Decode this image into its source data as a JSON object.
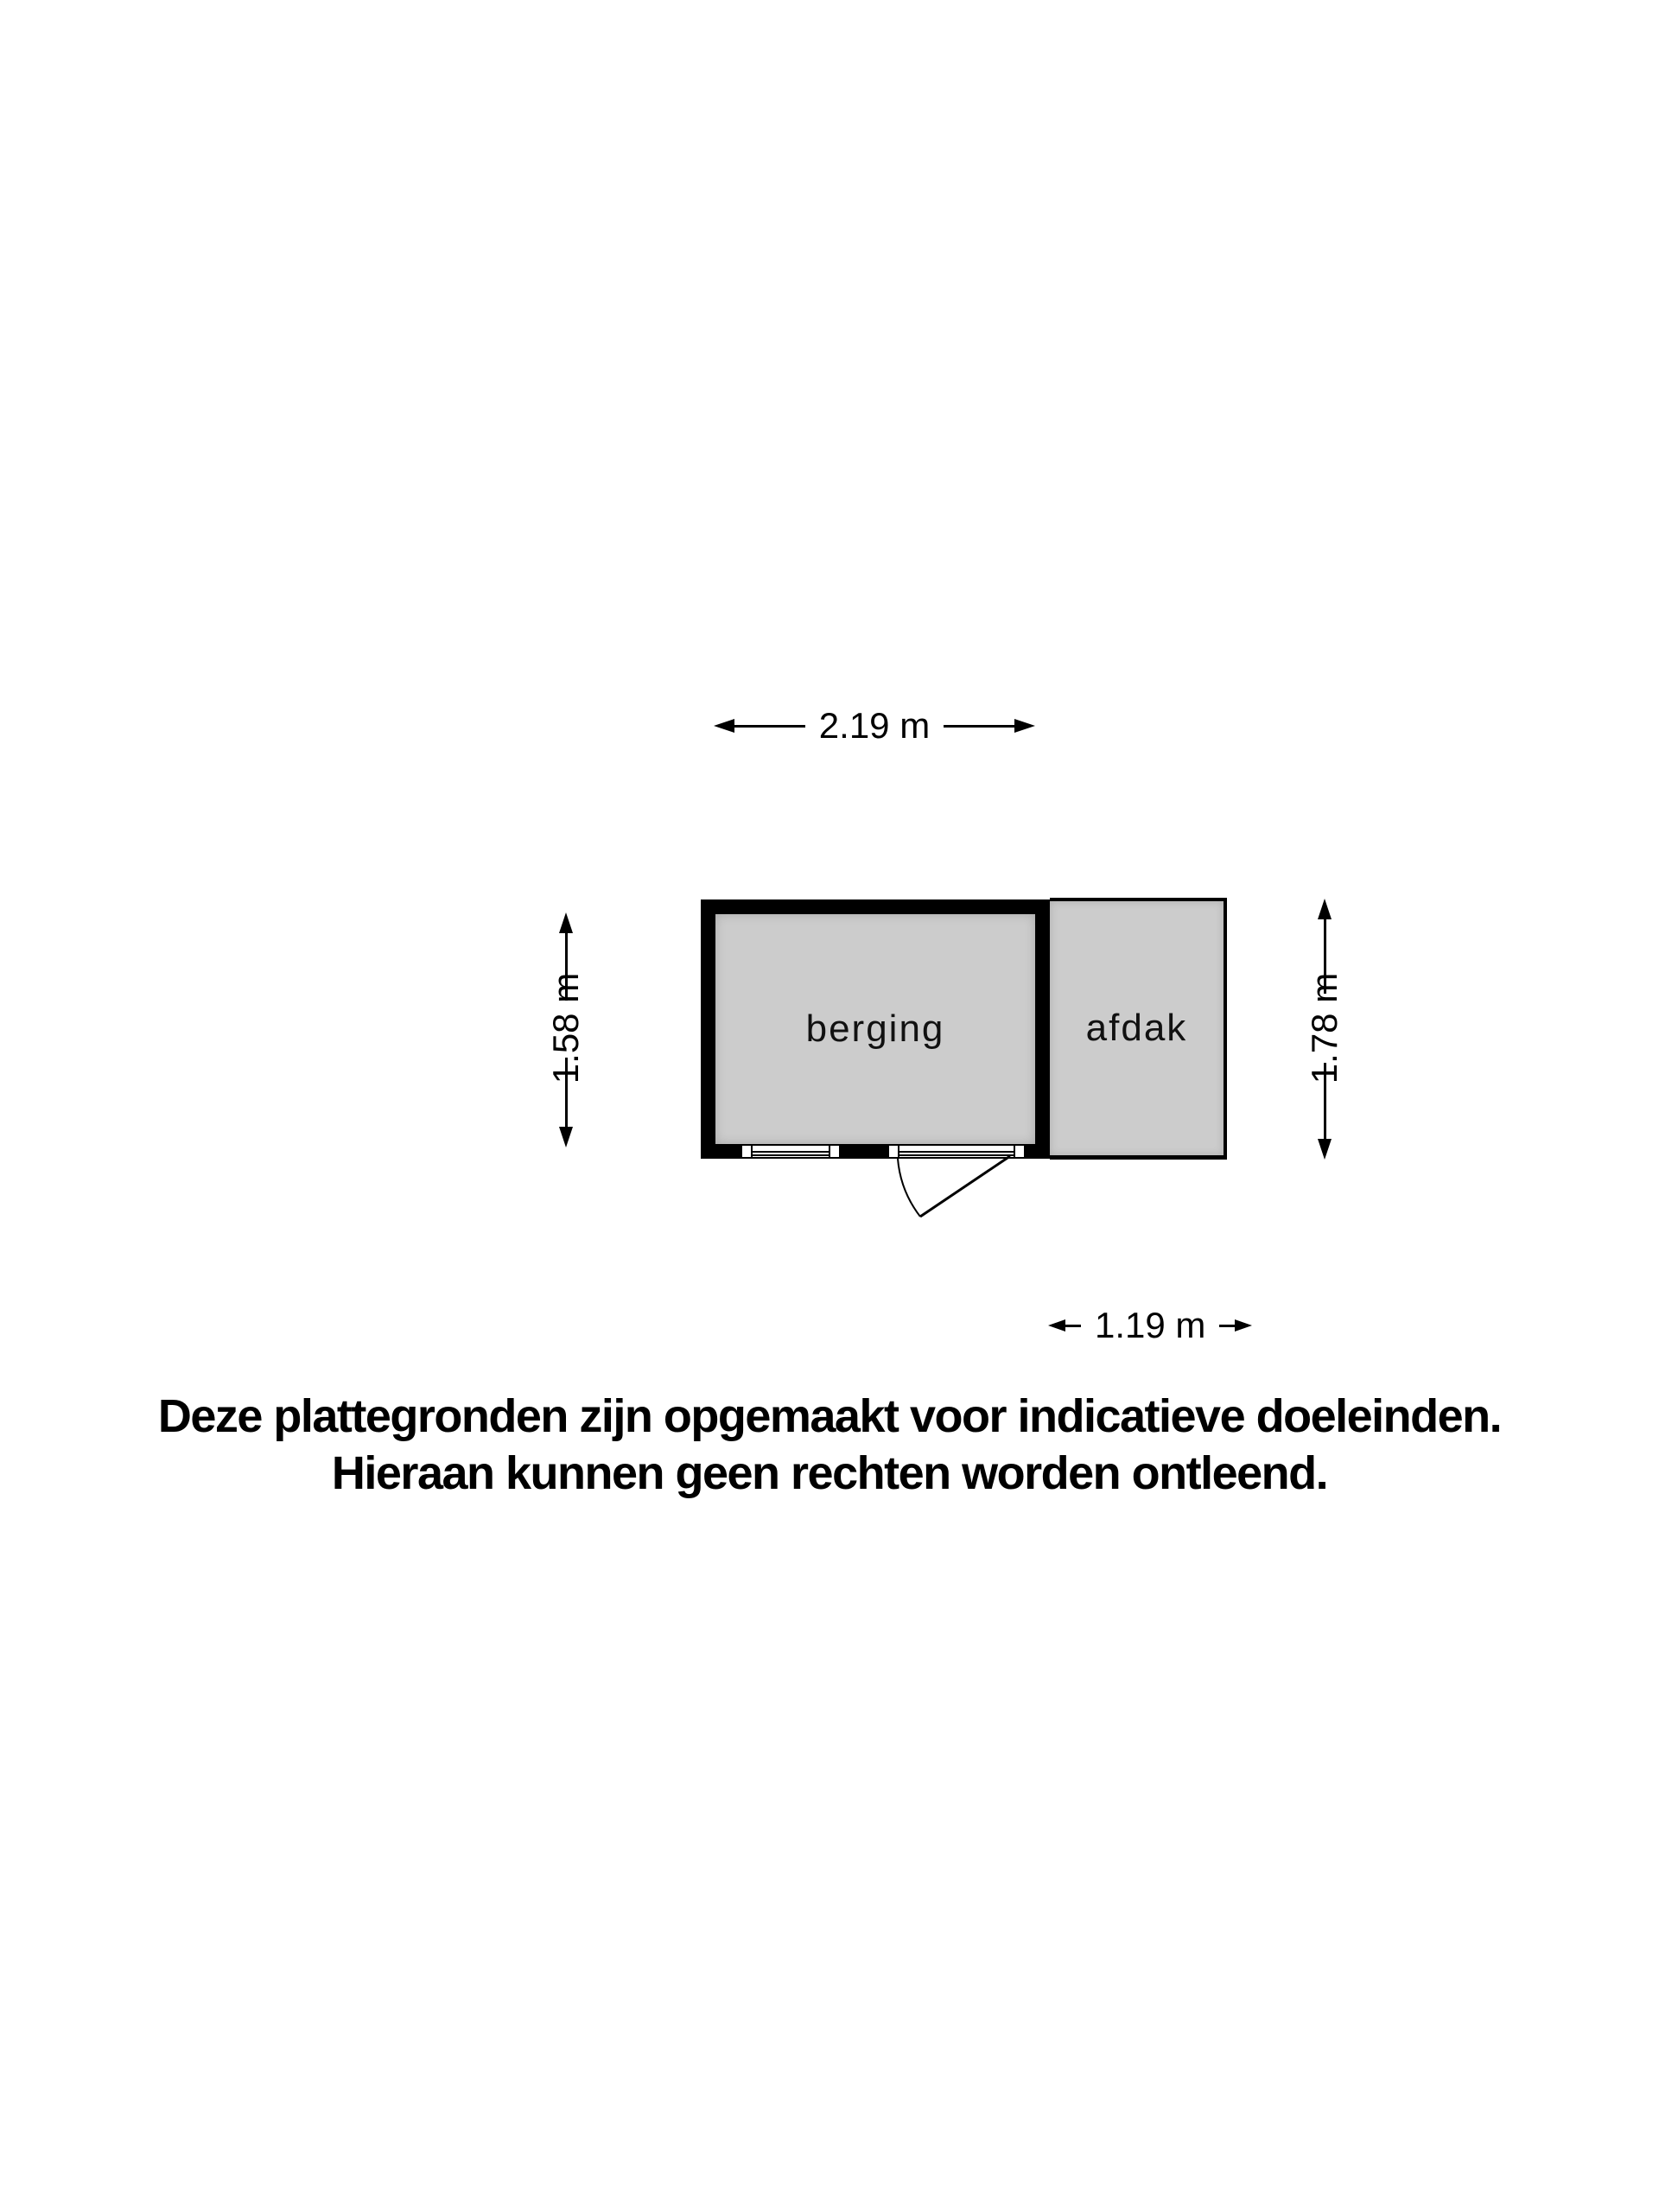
{
  "floorplan": {
    "rooms": [
      {
        "id": "berging",
        "label": "berging"
      },
      {
        "id": "afdak",
        "label": "afdak"
      }
    ],
    "dimensions": {
      "top": "2.19 m",
      "left": "1.58 m",
      "right": "1.78 m",
      "bottom": "1.19 m"
    },
    "features": {
      "windows": 2,
      "door": "outward-swing-bottom-right"
    },
    "colors": {
      "wall": "#000000",
      "floor": "#cccccc",
      "background": "#ffffff"
    }
  },
  "disclaimer": {
    "line1": "Deze plattegronden zijn opgemaakt voor indicatieve doeleinden.",
    "line2": "Hieraan kunnen geen rechten worden ontleend."
  }
}
